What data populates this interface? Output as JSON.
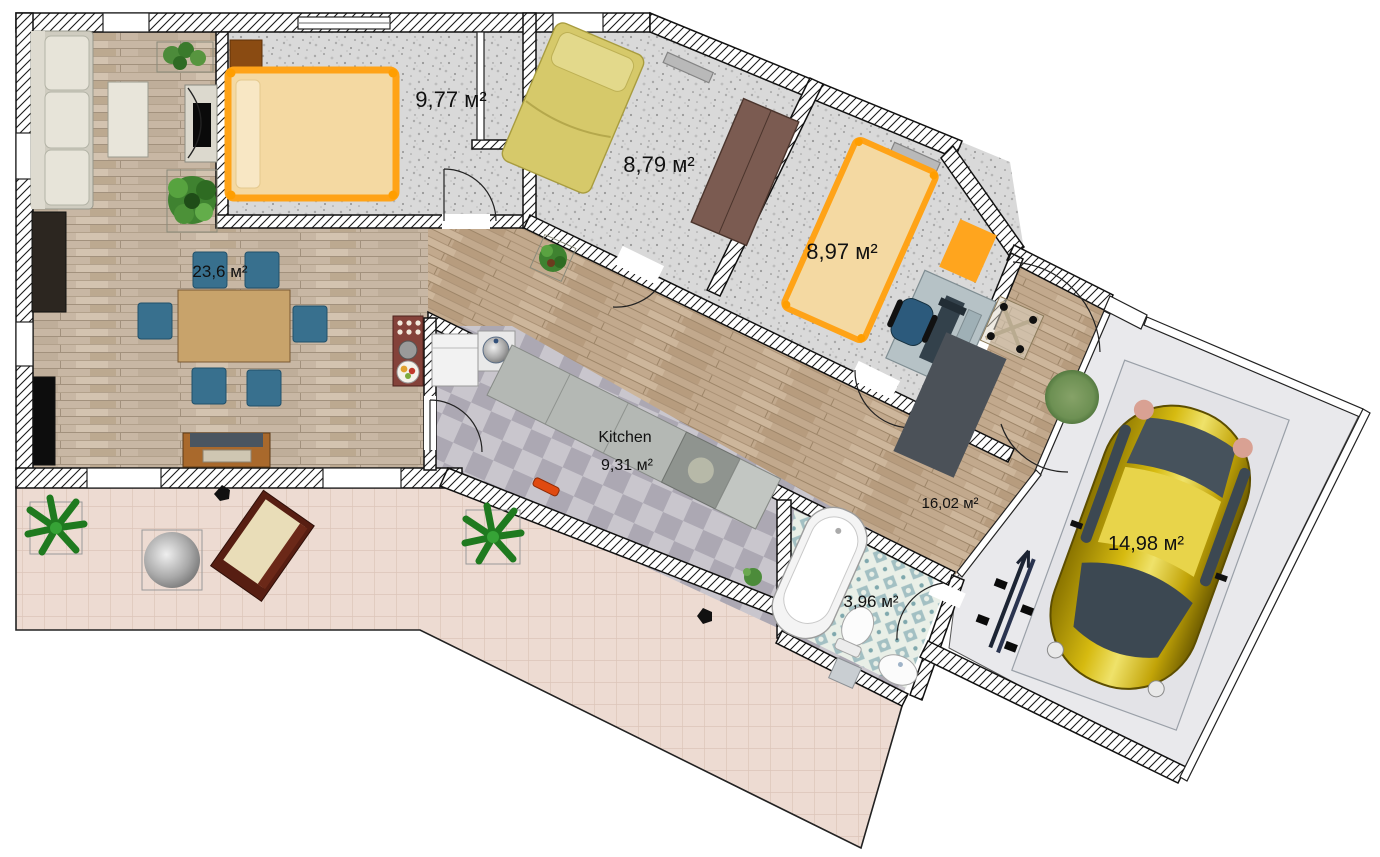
{
  "plan": {
    "type": "floor-plan",
    "area_unit": "м²"
  },
  "rooms": {
    "living_room": {
      "area_label": "23,6 м²"
    },
    "bedroom_1": {
      "area_label": "9,77 м²"
    },
    "bedroom_2": {
      "area_label": "8,79 м²"
    },
    "bedroom_3": {
      "area_label": "8,97 м²"
    },
    "kitchen": {
      "name": "Kitchen",
      "area_label": "9,31 м²"
    },
    "hallway": {
      "area_label": "16,02 м²"
    },
    "bathroom": {
      "area_label": "3,96 м²"
    },
    "garage": {
      "area_label": "14,98 м²"
    }
  },
  "colors": {
    "wall_line": "#111111",
    "accent_orange": "#ffa51e",
    "bed_linen": "#f4d9a2",
    "bed_yellow": "#d6c96a",
    "chair_blue": "#38708e",
    "car_yellow": "#d8b81e",
    "granite_floor": "#d8d8d8",
    "kitchen_tile_dark": "#b0acb6",
    "bath_tile": "#a8c4c6",
    "terrace_tile": "#eddbd2"
  }
}
